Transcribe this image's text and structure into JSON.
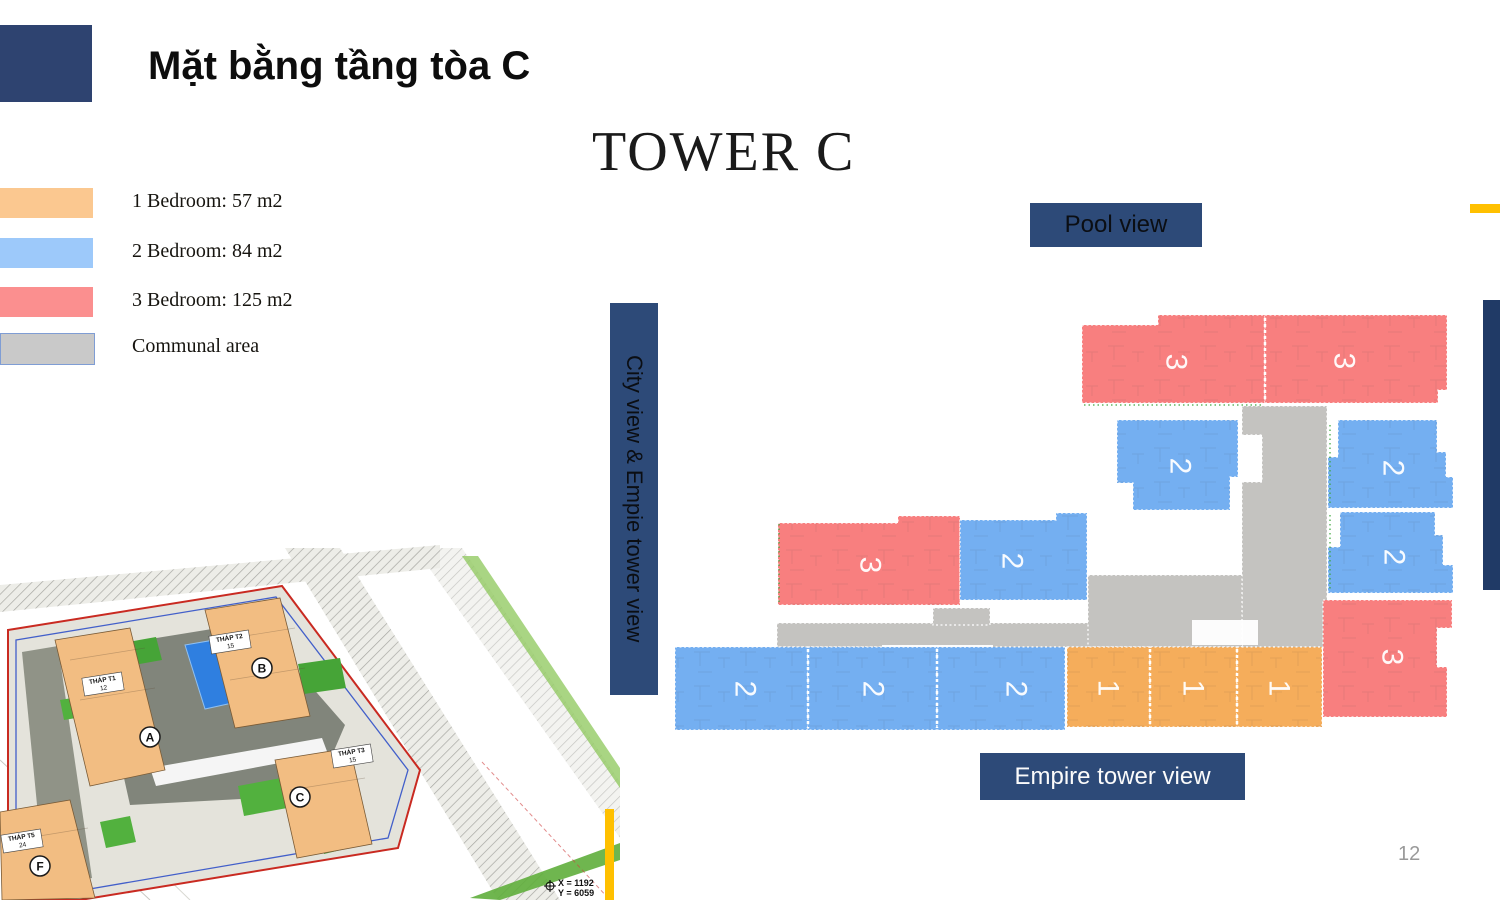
{
  "slide": {
    "title": "Mặt bằng tầng tòa C",
    "subtitle": "TOWER C",
    "page_number": "12"
  },
  "legend": {
    "items": [
      {
        "label": "1 Bedroom: 57 m2",
        "color": "#FBC890",
        "border": "none",
        "y": 188
      },
      {
        "label": "2 Bedroom: 84 m2",
        "color": "#9DC9FA",
        "border": "none",
        "y": 238
      },
      {
        "label": "3 Bedroom: 125 m2",
        "color": "#FB8F8F",
        "border": "none",
        "y": 287
      },
      {
        "label": "Communal area",
        "color": "#C9C9C9",
        "border": "#7F9DD4",
        "y": 333
      }
    ]
  },
  "view_labels": {
    "pool": "Pool view",
    "city": "City view & Empie tower view",
    "empire": "Empire tower view"
  },
  "floorplan": {
    "colors": {
      "1br": "#F5AD5B",
      "2br": "#74AFF1",
      "3br": "#F87F7F",
      "corridor": "#C4C3C0"
    },
    "corridors": [
      "1242,406 1327,406 1327,647 1242,647 1242,482 1262,482 1262,435 1242,435",
      "777,623 1242,623 1242,647 777,647",
      "933,608 990,608 990,625 933,625",
      "1088,575 1242,575 1242,647 1088,647"
    ],
    "white_patches": [
      "1192,620 1258,620 1258,645 1192,645",
      "882,645 993,645 993,656 882,656"
    ],
    "blocks": [
      {
        "type": "3br",
        "label": "3",
        "pts": "1082,325 1158,325 1158,315 1265,315 1265,403 1082,403",
        "lx": 1176,
        "ly": 362
      },
      {
        "type": "3br",
        "label": "3",
        "pts": "1265,315 1447,315 1447,390 1438,390 1438,403 1265,403",
        "lx": 1344,
        "ly": 361
      },
      {
        "type": "3br",
        "label": "3",
        "pts": "778,523 898,523 898,516 960,516 960,605 778,605",
        "lx": 870,
        "ly": 565
      },
      {
        "type": "3br",
        "label": "3",
        "pts": "1323,600 1452,600 1452,628 1437,628 1437,667 1447,667 1447,717 1323,717",
        "lx": 1392,
        "ly": 657
      },
      {
        "type": "2br",
        "label": "2",
        "pts": "1117,420 1238,420 1238,477 1230,477 1230,510 1133,510 1133,483 1117,483",
        "lx": 1180,
        "ly": 466
      },
      {
        "type": "2br",
        "label": "2",
        "pts": "1338,420 1437,420 1437,452 1446,452 1446,477 1453,477 1453,508 1328,508 1328,457 1338,457",
        "lx": 1393,
        "ly": 468
      },
      {
        "type": "2br",
        "label": "2",
        "pts": "1340,512 1435,512 1435,535 1443,535 1443,565 1453,565 1453,593 1328,593 1328,547 1340,547",
        "lx": 1394,
        "ly": 557
      },
      {
        "type": "2br",
        "label": "2",
        "pts": "960,520 1056,520 1056,513 1087,513 1087,600 960,600",
        "lx": 1012,
        "ly": 561
      },
      {
        "type": "2br",
        "label": "2",
        "pts": "675,647 808,647 808,730 675,730",
        "lx": 745,
        "ly": 689
      },
      {
        "type": "2br",
        "label": "2",
        "pts": "808,647 937,647 937,730 808,730",
        "lx": 873,
        "ly": 689
      },
      {
        "type": "2br",
        "label": "2",
        "pts": "937,647 1065,647 1065,730 937,730",
        "lx": 1016,
        "ly": 689
      },
      {
        "type": "1br",
        "label": "1",
        "pts": "1067,647 1150,647 1150,727 1067,727",
        "lx": 1108,
        "ly": 688
      },
      {
        "type": "1br",
        "label": "1",
        "pts": "1150,647 1237,647 1237,727 1150,727",
        "lx": 1193,
        "ly": 688
      },
      {
        "type": "1br",
        "label": "1",
        "pts": "1237,647 1322,647 1322,727 1237,727",
        "lx": 1279,
        "ly": 688
      }
    ],
    "separators": [
      [
        1265,
        318,
        1265,
        402
      ],
      [
        808,
        649,
        808,
        728
      ],
      [
        937,
        649,
        937,
        728
      ],
      [
        1150,
        649,
        1150,
        725
      ],
      [
        1237,
        649,
        1237,
        725
      ],
      [
        1332,
        510,
        1450,
        510
      ]
    ],
    "accents": [
      [
        1330,
        425,
        1330,
        505
      ],
      [
        1330,
        515,
        1330,
        590
      ],
      [
        1084,
        405,
        1262,
        405
      ],
      [
        779,
        524,
        779,
        604
      ]
    ]
  },
  "siteplan": {
    "prims": [
      {
        "k": "poly",
        "pts": "0,585 440,545 440,568 0,612",
        "fill": "url(#hatch)"
      },
      {
        "k": "poly",
        "pts": "285,548 340,548 560,900 498,900",
        "fill": "url(#hatch)"
      },
      {
        "k": "poly",
        "pts": "415,548 462,548 620,782 620,838",
        "fill": "url(#hatch)",
        "op": 0.65
      },
      {
        "k": "poly",
        "pts": "462,556 478,556 620,768 620,788",
        "fill": "#8CC75A",
        "op": 0.75
      },
      {
        "k": "poly",
        "pts": "470,898 620,843 620,860 500,900",
        "fill": "#5FAE3C",
        "op": 0.9
      },
      {
        "k": "line",
        "x1": 0,
        "y1": 760,
        "x2": 150,
        "y2": 900,
        "stroke": "#c9c9c4",
        "sw": 1
      },
      {
        "k": "line",
        "x1": 30,
        "y1": 745,
        "x2": 190,
        "y2": 900,
        "stroke": "#d8d8d2",
        "sw": 1
      },
      {
        "k": "line",
        "x1": 482,
        "y1": 762,
        "x2": 610,
        "y2": 900,
        "stroke": "#D04040",
        "sw": 1,
        "dash": "4 3",
        "op": 0.6
      },
      {
        "k": "poly",
        "pts": "8,630 282,586 420,770 398,848 80,900 8,900",
        "fill": "#E4E3DB"
      },
      {
        "k": "poly",
        "pts": "8,630 282,586 420,770 398,848 80,900 8,900",
        "fill": "none",
        "stroke": "#C92A21",
        "sw": 2
      },
      {
        "k": "poly",
        "pts": "16,640 276,597 408,770 388,838 78,891 16,891",
        "fill": "none",
        "stroke": "#3050C8",
        "sw": 1.3,
        "op": 0.9
      },
      {
        "k": "poly",
        "pts": "95,648 255,622 345,725 315,795 130,805",
        "fill": "#70746A",
        "op": 0.85
      },
      {
        "k": "poly",
        "pts": "22,652 58,646 92,878 45,886",
        "fill": "#7A7E72",
        "op": 0.8
      },
      {
        "k": "poly",
        "pts": "150,768 322,738 328,754 156,786",
        "fill": "#FFFFFF",
        "op": 0.92
      },
      {
        "k": "poly",
        "pts": "228,640 246,637 262,700 244,704",
        "fill": "#FFFFFF",
        "op": 0.85
      },
      {
        "k": "poly",
        "pts": "185,645 226,638 246,700 205,709",
        "fill": "#2F7FE0",
        "stroke": "#8FC0F2",
        "sw": 1
      },
      {
        "k": "poly",
        "pts": "128,642 156,637 162,660 134,665",
        "fill": "#46A437"
      },
      {
        "k": "poly",
        "pts": "298,664 340,658 346,688 304,694",
        "fill": "#46A437"
      },
      {
        "k": "poly",
        "pts": "238,786 292,776 298,806 244,816",
        "fill": "#52B13E"
      },
      {
        "k": "poly",
        "pts": "100,822 130,816 136,842 106,848",
        "fill": "#52B13E"
      },
      {
        "k": "poly",
        "pts": "318,830 352,822 358,846 324,854",
        "fill": "#46A437"
      },
      {
        "k": "poly",
        "pts": "60,700 84,696 88,716 64,720",
        "fill": "#52B13E"
      },
      {
        "k": "poly",
        "pts": "55,640 130,628 165,770 90,786",
        "fill": "#F2BD82",
        "stroke": "#7A5B36",
        "sw": 0.8
      },
      {
        "k": "poly",
        "pts": "205,610 280,598 310,716 235,728",
        "fill": "#F2BD82",
        "stroke": "#7A5B36",
        "sw": 0.8
      },
      {
        "k": "poly",
        "pts": "275,760 350,748 372,844 297,858",
        "fill": "#F2BD82",
        "stroke": "#7A5B36",
        "sw": 0.8
      },
      {
        "k": "poly",
        "pts": "0,812 70,800 95,898 2,900",
        "fill": "#F2BD82",
        "stroke": "#7A5B36",
        "sw": 0.8
      },
      {
        "k": "line",
        "x1": 70,
        "y1": 660,
        "x2": 145,
        "y2": 648,
        "stroke": "#5a4632",
        "sw": 0.7,
        "op": 0.3
      },
      {
        "k": "line",
        "x1": 80,
        "y1": 700,
        "x2": 155,
        "y2": 688,
        "stroke": "#5a4632",
        "sw": 0.7,
        "op": 0.3
      },
      {
        "k": "line",
        "x1": 220,
        "y1": 640,
        "x2": 295,
        "y2": 628,
        "stroke": "#5a4632",
        "sw": 0.7,
        "op": 0.3
      },
      {
        "k": "line",
        "x1": 230,
        "y1": 680,
        "x2": 305,
        "y2": 668,
        "stroke": "#5a4632",
        "sw": 0.7,
        "op": 0.3
      },
      {
        "k": "line",
        "x1": 290,
        "y1": 790,
        "x2": 365,
        "y2": 778,
        "stroke": "#5a4632",
        "sw": 0.7,
        "op": 0.3
      },
      {
        "k": "line",
        "x1": 15,
        "y1": 840,
        "x2": 88,
        "y2": 828,
        "stroke": "#5a4632",
        "sw": 0.7,
        "op": 0.3
      },
      {
        "k": "label",
        "x": 103,
        "y": 684,
        "l1": "THÁP T1",
        "l2": "12"
      },
      {
        "k": "label",
        "x": 230,
        "y": 642,
        "l1": "THÁP T2",
        "l2": "15"
      },
      {
        "k": "label",
        "x": 352,
        "y": 756,
        "l1": "THÁP T3",
        "l2": "15"
      },
      {
        "k": "label",
        "x": 22,
        "y": 841,
        "l1": "THÁP T5",
        "l2": "24"
      },
      {
        "k": "circle",
        "x": 150,
        "y": 737,
        "t": "A"
      },
      {
        "k": "circle",
        "x": 262,
        "y": 668,
        "t": "B"
      },
      {
        "k": "circle",
        "x": 300,
        "y": 797,
        "t": "C"
      },
      {
        "k": "circle",
        "x": 40,
        "y": 866,
        "t": "F"
      },
      {
        "k": "anchor",
        "x": 550,
        "y": 886
      },
      {
        "k": "text",
        "x": 558,
        "y": 886,
        "t": "X = 1192",
        "s": 9
      },
      {
        "k": "text",
        "x": 558,
        "y": 896,
        "t": "Y = 6059",
        "s": 9
      }
    ]
  }
}
